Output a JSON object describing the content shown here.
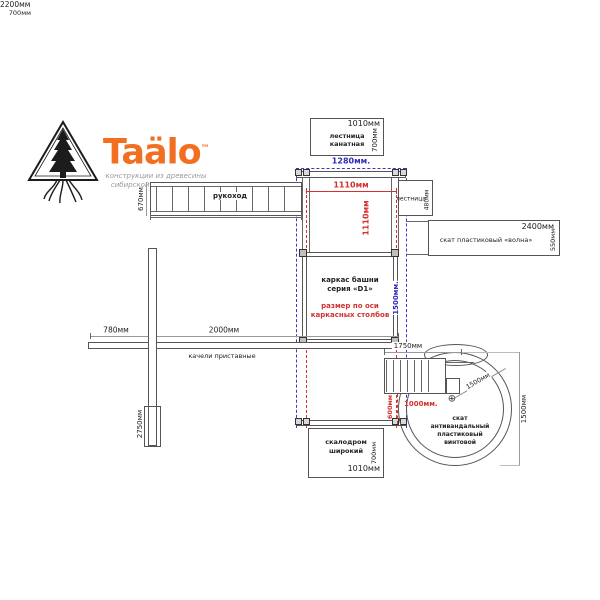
{
  "logo": {
    "brand": "Taälo",
    "tm": "™",
    "subtitle_line1": "конструкции из древесины",
    "subtitle_line2": "сибирской лиственницы"
  },
  "icons": {
    "center_marker": "⊕"
  },
  "colors": {
    "accent_orange": "#F26F21",
    "dim_red": "#D43030",
    "dim_blue": "#2D2DB8"
  },
  "top_rope_ladder": {
    "label_line1": "лестница",
    "label_line2": "канатная",
    "width_dim": "1010мм",
    "depth_dim": "700мм"
  },
  "axis_dims": {
    "outer_width_blue": "1280мм.",
    "inner_width_red": "1110мм",
    "inner_width_red_vertical": "1110мм",
    "tower_depth_blue": "1500мм."
  },
  "monkey_bars": {
    "label": "рукоход",
    "height_dim": "670мм",
    "length_dim": "2200мм"
  },
  "side_ladder": {
    "label": "лестница",
    "width_dim": "700мм",
    "depth_dim": "480мм"
  },
  "wave_slide": {
    "label": "скат пластиковый «волна»",
    "length_dim": "2400мм",
    "width_dim": "550мм"
  },
  "tower": {
    "label_line1": "каркас башни",
    "label_line2": "серия «D1»",
    "note_line1": "размер по оси",
    "note_line2": "каркасных столбов"
  },
  "swing": {
    "label": "качели приставные",
    "offset_dim": "780мм",
    "length_dim": "2000мм",
    "post_height_dim": "2750мм"
  },
  "climbing_wall": {
    "label_line1": "скалодром",
    "label_line2": "широкий",
    "depth_dim": "700мм",
    "width_dim": "1010мм"
  },
  "spiral_slide": {
    "label_line1": "скат",
    "label_line2": "антивандальный",
    "label_line3": "пластиковый",
    "label_line4": "винтовой",
    "stairs_length_dim": "1750мм",
    "stairs_width_dim": "600мм",
    "landing_dim": "1000мм.",
    "radius_dim": "1500мм",
    "height_dim": "1500мм"
  }
}
